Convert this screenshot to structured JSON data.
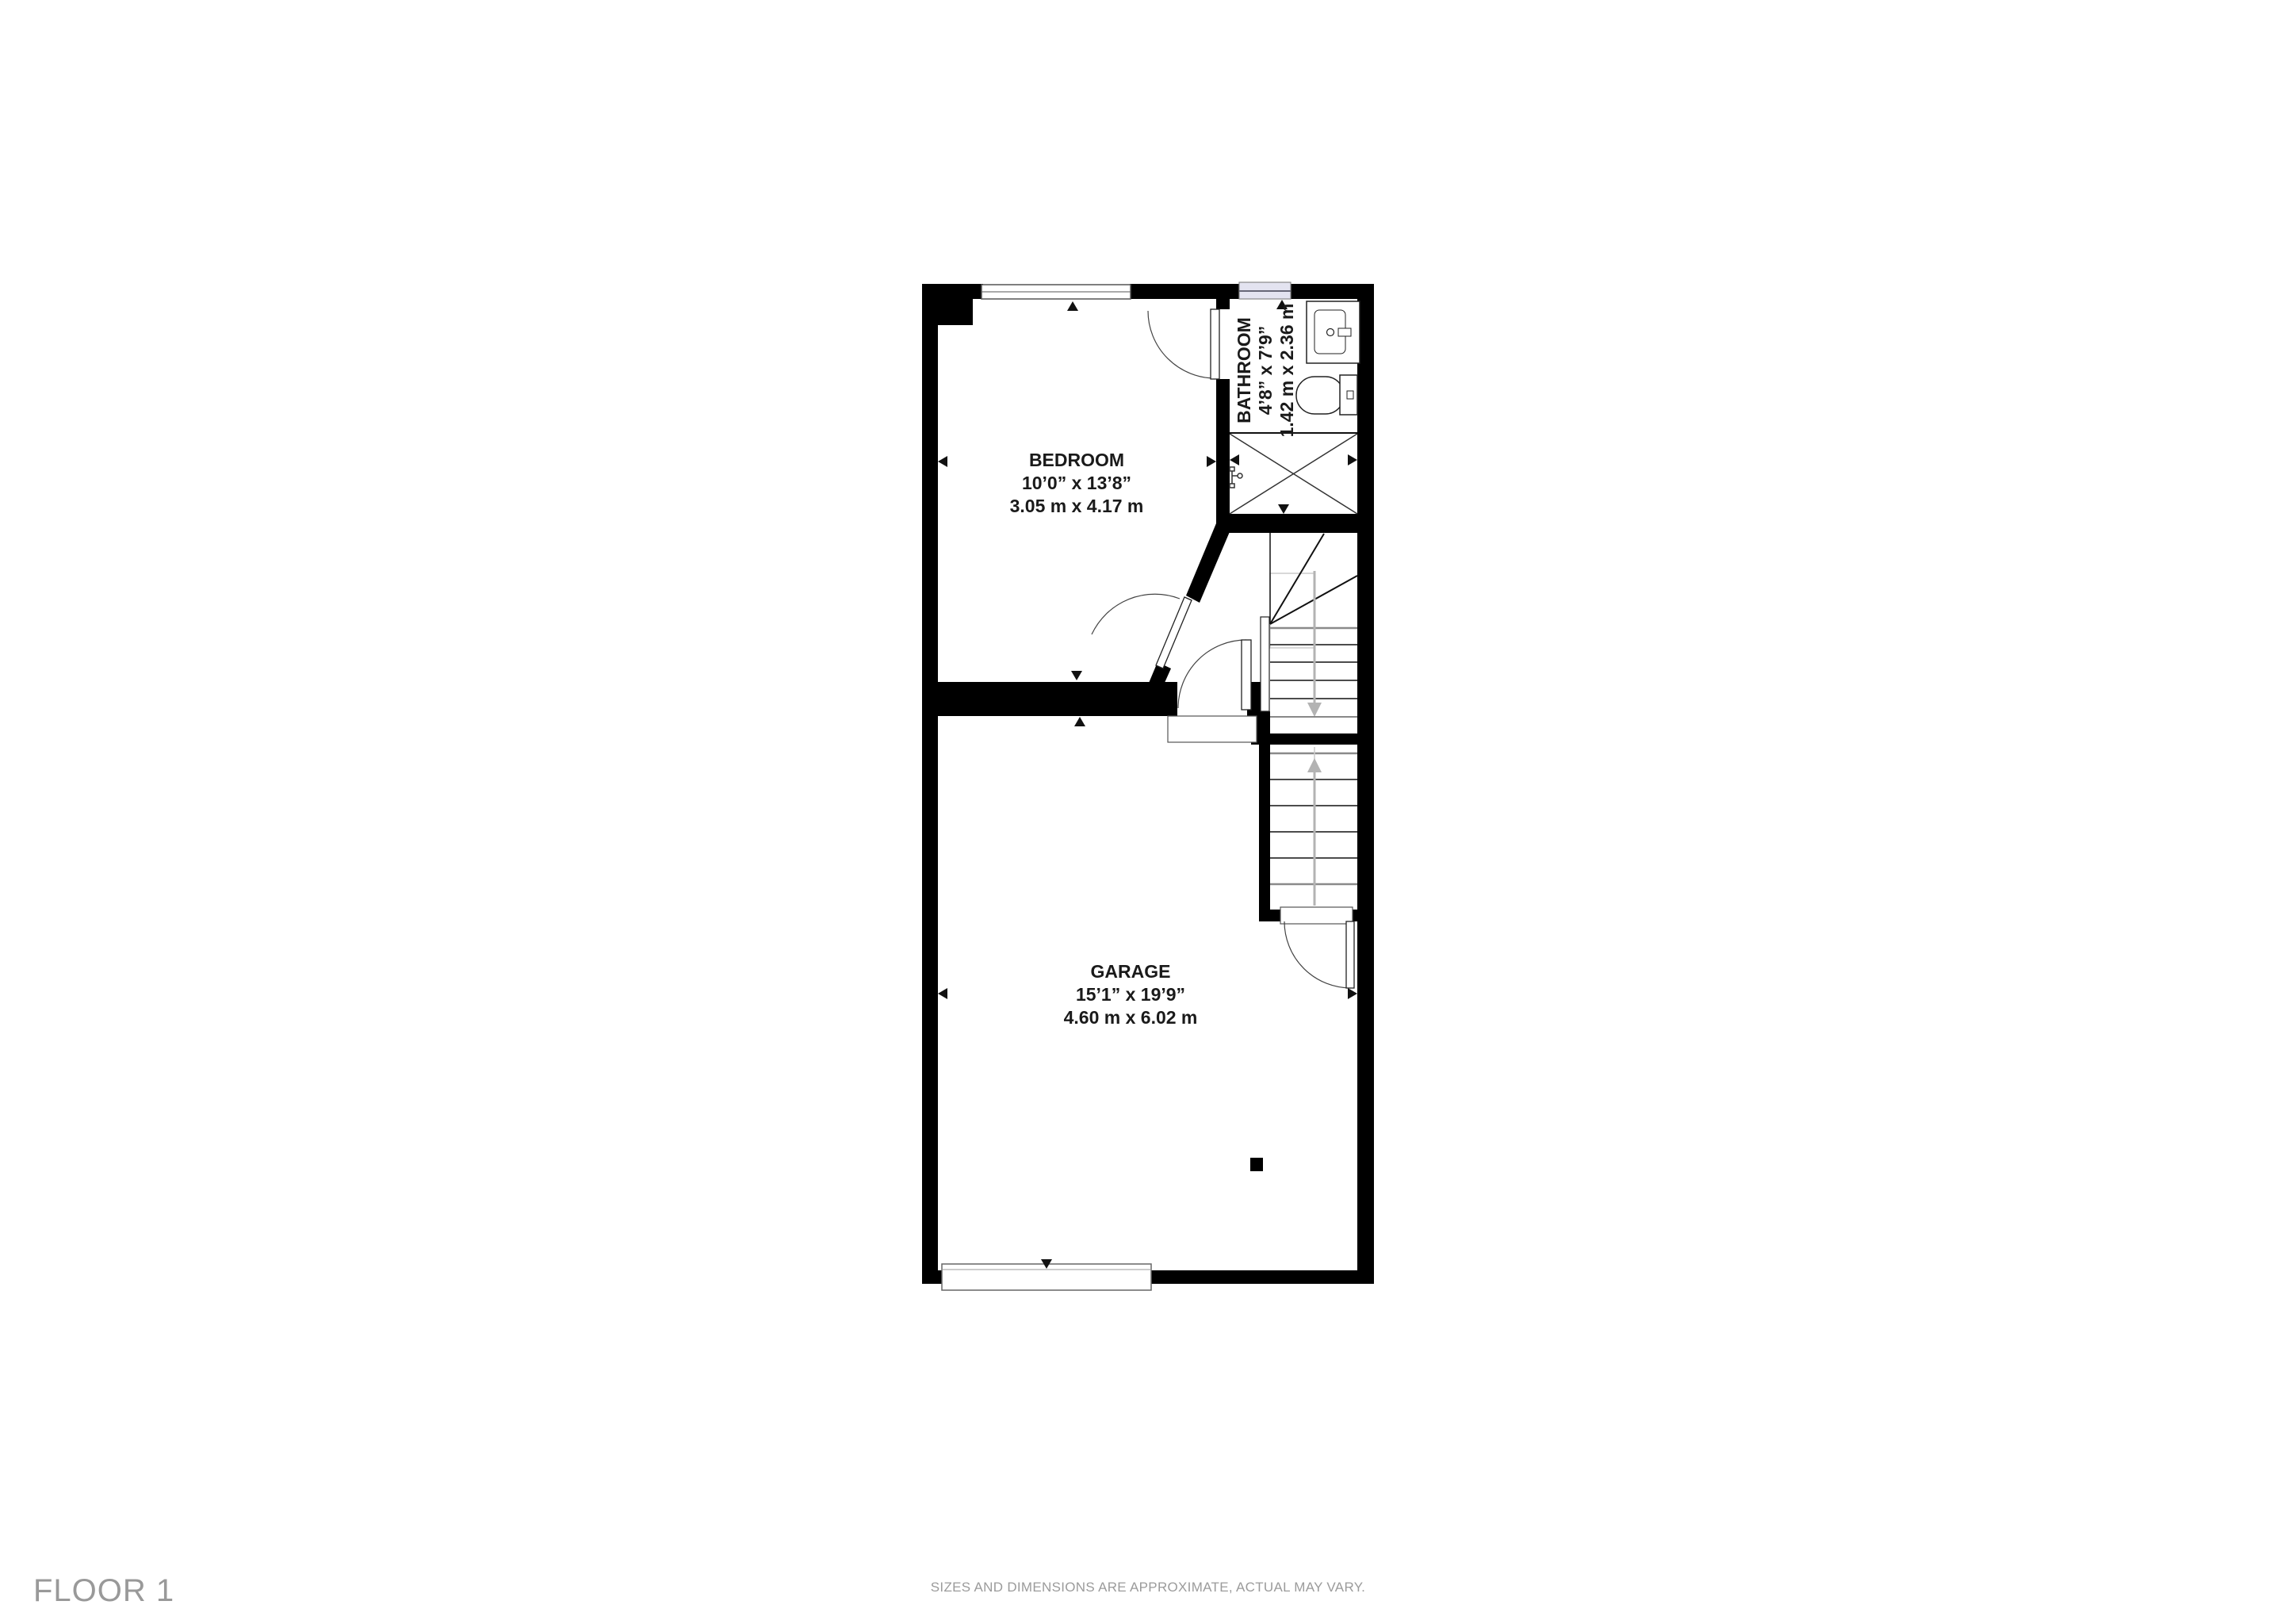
{
  "floor_plan": {
    "rooms": {
      "bedroom": {
        "name": "BEDROOM",
        "size_imperial": "10’0” x 13’8”",
        "size_metric": "3.05 m x 4.17 m"
      },
      "bathroom": {
        "name": "BATHROOM",
        "size_imperial": "4’8” x 7’9”",
        "size_metric": "1.42 m x 2.36 m"
      },
      "garage": {
        "name": "GARAGE",
        "size_imperial": "15’1” x 19’9”",
        "size_metric": "4.60 m x 6.02 m"
      }
    },
    "colors": {
      "wall": "#000000",
      "window_glass": "#e3e3f0",
      "stair_arrow": "#b3b3b3",
      "label_text": "#1a1a1a",
      "footer_text": "#9b9b9b"
    }
  },
  "footer": {
    "floor_label": "FLOOR 1",
    "disclaimer": "SIZES AND DIMENSIONS ARE APPROXIMATE, ACTUAL MAY VARY."
  }
}
